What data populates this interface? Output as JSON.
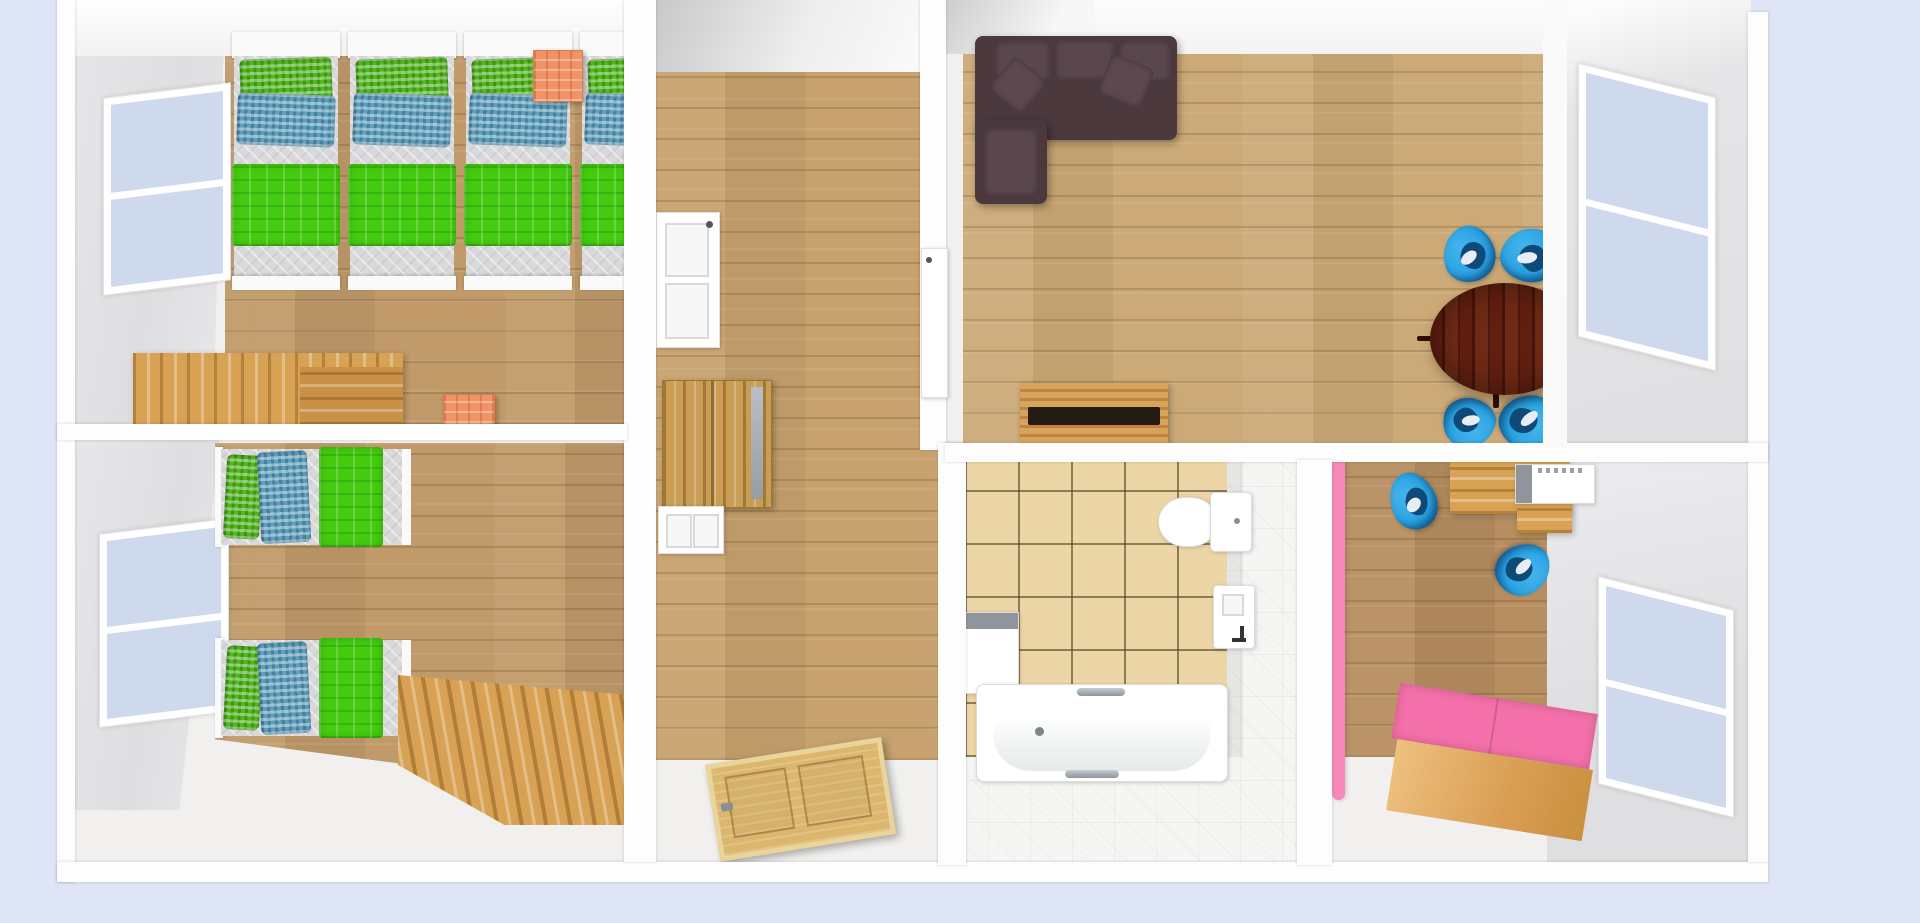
{
  "meta": {
    "app": "3D home design floor-plan render",
    "view": "top-down 3D perspective",
    "visible_text": "none"
  },
  "palette": {
    "bg": "#dde5f6",
    "wall": "#fdfdfd",
    "wall_face": "#e3e3e5",
    "floor_light": "#f1f0ee",
    "wood_room": "#c09a69",
    "wood_hall": "#c7a26e",
    "wood_living": "#ccaa77",
    "wood_office": "#b68e60",
    "wood_furniture": "#d8a254",
    "wood_door": "#dcb66c",
    "tile_beige": "#edd6a6",
    "tile_white": "#f5f5f3",
    "mattress": "#d9d9db",
    "bed_frame": "#fafafa",
    "green_blanket": "#44cb10",
    "green_pillow": "#53b81e",
    "blue_pillow": "#5fa0bd",
    "orange_unit": "#f09468",
    "sofa_body": "#4b393e",
    "sofa_accent": "#5a464d",
    "table_mahogany": "#5a1d0f",
    "chair_blue": "#2aa2e2",
    "chair_blue_dark": "#0e4a78",
    "pink_shelf": "#f788b8",
    "pink_bench": "#f470aa",
    "window_pane": "#cfd9ed",
    "appliance_gray": "#8f959b",
    "fixture_white": "#ffffff"
  },
  "rooms": [
    {
      "id": "bedroom-top-left",
      "label": "Bedroom A - three single beds plus one partly hidden, orange nightstands, wooden desk, window on left wall"
    },
    {
      "id": "bedroom-bottom-left",
      "label": "Bedroom B - two single beds, wooden corner desk, window on left wall"
    },
    {
      "id": "hallway",
      "label": "Hallway - wooden wardrobe, white interior door, open wooden entrance door"
    },
    {
      "id": "living-room",
      "label": "Living room - dark corner sofa, wooden sideboard, round dining table with four blue chairs, window on right wall"
    },
    {
      "id": "bathroom",
      "label": "Bathroom - bathtub, toilet, wall sink, washing machine, beige floor tiles"
    },
    {
      "id": "study-room",
      "label": "Study - desk with computer, two blue chairs, pink shelf, pink storage bench, window on right wall"
    }
  ],
  "furniture": {
    "single_bed": "Single bed with green duvet and green/blue checked pillows",
    "nightstand": "Orange nightstand",
    "desk": "Wooden desk",
    "wardrobe": "Wooden wardrobe with mirror strip",
    "interior_door": "White interior door",
    "open_door": "Open wooden panel door",
    "hall_door": "Interior door between hallway and living room",
    "sofa": "Dark brown corner sofa with two cushions",
    "sideboard": "Wooden sideboard with dark top unit",
    "dining_table": "Round dark mahogany dining table",
    "dining_chair": "Blue shell chair",
    "toilet": "Toilet",
    "sink": "Wall-mounted sink with faucet",
    "bathtub": "White bathtub with chrome grab rails",
    "washing_machine": "Washing machine with gray lid",
    "computer": "Desktop computer on desk",
    "office_chair": "Blue desk chair",
    "pink_shelf": "Pink wall shelf",
    "pink_bench": "Pink-topped wooden storage bench",
    "window": "Double-pane window"
  }
}
